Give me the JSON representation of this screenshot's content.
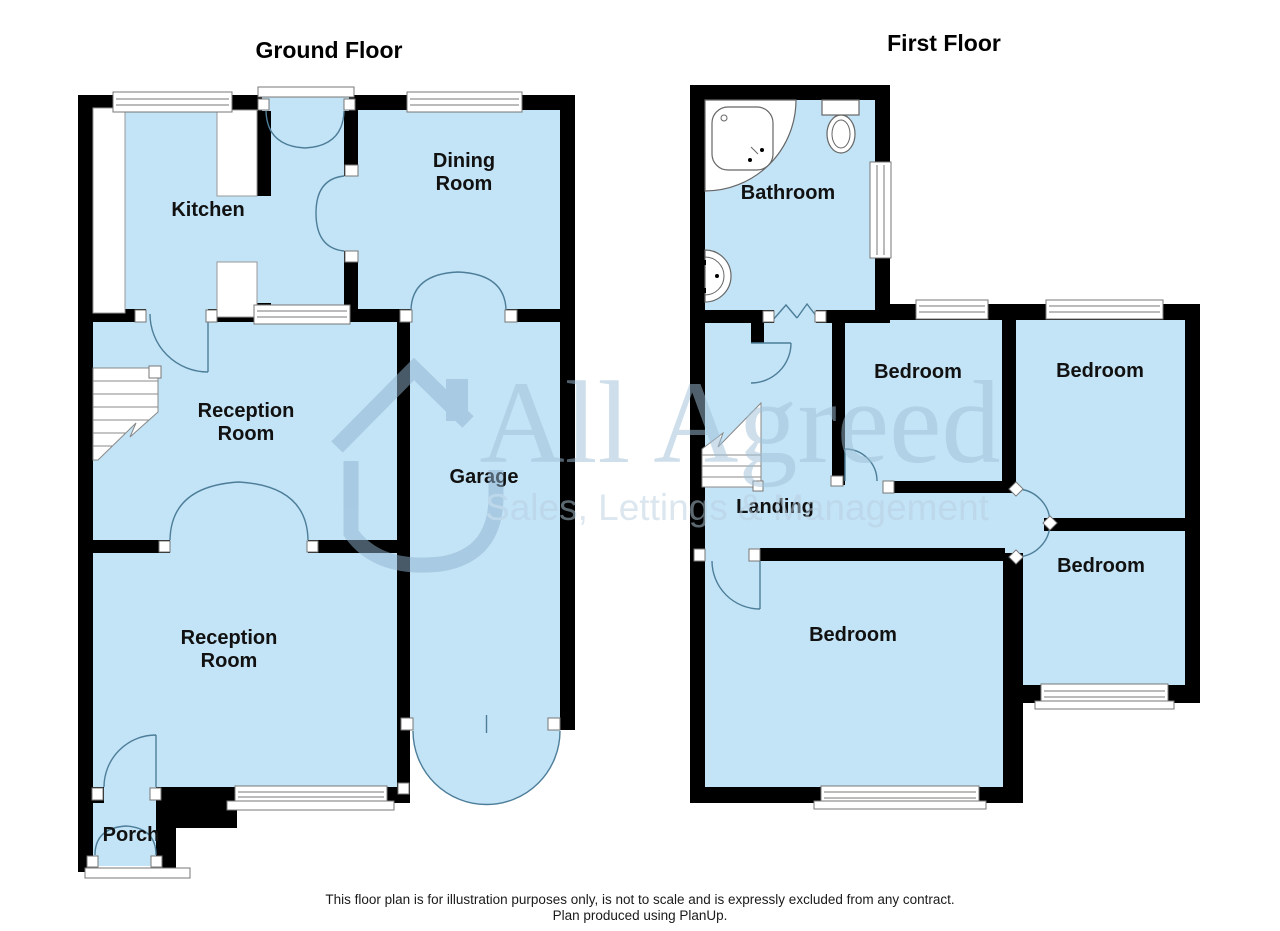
{
  "ground_floor": {
    "title": "Ground Floor",
    "labels": {
      "kitchen": "Kitchen",
      "dining_line1": "Dining",
      "dining_line2": "Room",
      "reception_front_line1": "Reception",
      "reception_front_line2": "Room",
      "garage": "Garage",
      "reception_back_line1": "Reception",
      "reception_back_line2": "Room",
      "porch": "Porch"
    }
  },
  "first_floor": {
    "title": "First Floor",
    "labels": {
      "bathroom": "Bathroom",
      "bedroom_mid": "Bedroom",
      "bedroom_top_right": "Bedroom",
      "landing": "Landing",
      "bedroom_back_right": "Bedroom",
      "bedroom_front": "Bedroom"
    }
  },
  "watermark": {
    "brand": "All Agreed",
    "tagline": "Sales, Lettings & Management"
  },
  "footer": {
    "line1": "This floor plan is for illustration purposes only, is not to scale and is expressly excluded from any contract.",
    "line2": "Plan produced using PlanUp."
  },
  "colors": {
    "floor": "#c3e3f6",
    "wall": "#000000",
    "door_arc": "#4d7e99",
    "watermark_brand": "#9fc0d8",
    "watermark_tagline": "#b8cfe0",
    "watermark_house": "#8fb3cf"
  }
}
